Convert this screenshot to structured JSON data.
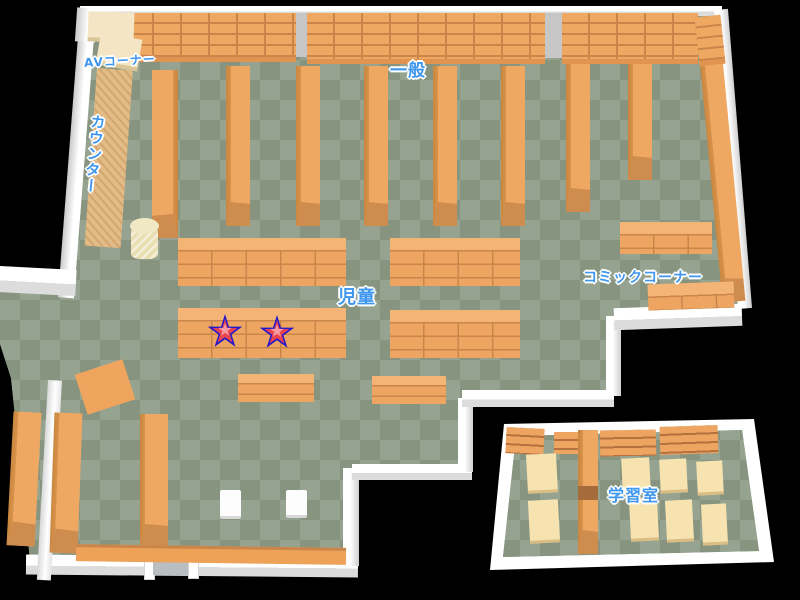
{
  "map": {
    "type": "library-floor-map",
    "areas": [
      {
        "id": "av-corner",
        "label": "AVコーナー"
      },
      {
        "id": "general",
        "label": "一般"
      },
      {
        "id": "counter",
        "label": "カウンター"
      },
      {
        "id": "children",
        "label": "児童"
      },
      {
        "id": "comic-corner",
        "label": "コミックコーナー"
      },
      {
        "id": "study-room",
        "label": "学習室"
      }
    ],
    "markers": [
      {
        "id": "star-1",
        "type": "star"
      },
      {
        "id": "star-2",
        "type": "star"
      }
    ],
    "colors": {
      "background": "#000000",
      "floor_light": "#96a390",
      "floor_dark": "#87947f",
      "shelf_orange": "#efa862",
      "shelf_shadow": "#c8873f",
      "wall_white": "#ffffff",
      "desk_cream": "#f6e3b0",
      "counter_tan": "#e3bb87",
      "label_blue": "#3f96ee",
      "star_outline": "#2217cc",
      "star_fill": "#e94450",
      "star_highlight": "#f59aa0"
    }
  }
}
